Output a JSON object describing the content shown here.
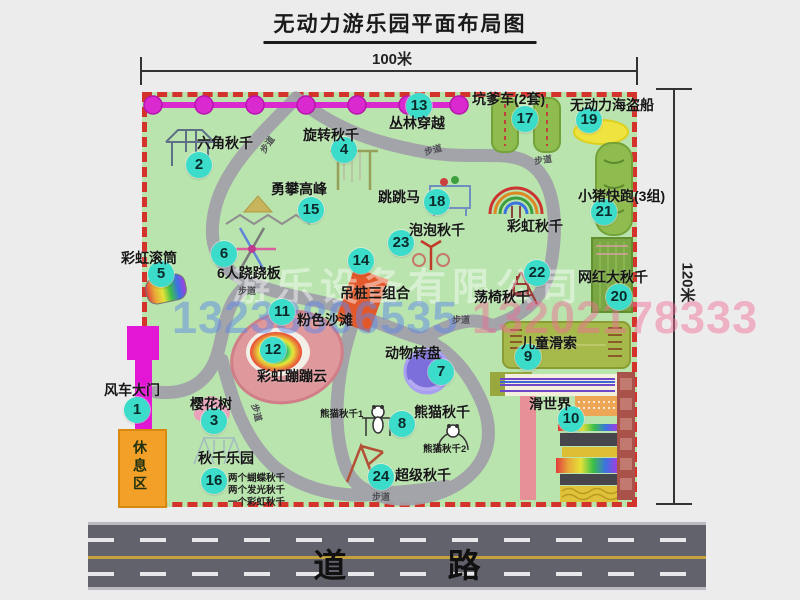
{
  "title": "无动力游乐园平面布局图",
  "dimensions": {
    "width_label": "100米",
    "height_label": "120米"
  },
  "road": {
    "label": "道 路"
  },
  "watermark": {
    "company": "游乐设备有限公司",
    "phone1": "13233806535",
    "phone2": "13202178333"
  },
  "rest_area_label": "休息区",
  "path_label_text": "步道",
  "items": [
    {
      "num": "1",
      "label": "风车大门",
      "bx": 137,
      "by": 410,
      "lx": 104,
      "ly": 380
    },
    {
      "num": "2",
      "label": "六角秋千",
      "bx": 199,
      "by": 165,
      "lx": 197,
      "ly": 133
    },
    {
      "num": "3",
      "label": "樱花树",
      "bx": 214,
      "by": 421,
      "lx": 190,
      "ly": 394
    },
    {
      "num": "4",
      "label": "旋转秋千",
      "bx": 344,
      "by": 150,
      "lx": 303,
      "ly": 125
    },
    {
      "num": "5",
      "label": "彩虹滚筒",
      "bx": 161,
      "by": 274,
      "lx": 121,
      "ly": 248
    },
    {
      "num": "6",
      "label": "6人跷跷板",
      "bx": 224,
      "by": 254,
      "lx": 217,
      "ly": 263
    },
    {
      "num": "7",
      "label": "动物转盘",
      "bx": 441,
      "by": 372,
      "lx": 385,
      "ly": 343
    },
    {
      "num": "8",
      "label": "熊猫秋千",
      "bx": 402,
      "by": 424,
      "lx": 414,
      "ly": 402
    },
    {
      "num": "9",
      "label": "儿童滑索",
      "bx": 528,
      "by": 357,
      "lx": 521,
      "ly": 333
    },
    {
      "num": "10",
      "label": "滑世界",
      "bx": 571,
      "by": 419,
      "lx": 529,
      "ly": 394
    },
    {
      "num": "11",
      "label": "粉色沙滩",
      "bx": 282,
      "by": 312,
      "lx": 297,
      "ly": 310
    },
    {
      "num": "12",
      "label": "彩虹蹦蹦云",
      "bx": 273,
      "by": 350,
      "lx": 257,
      "ly": 366
    },
    {
      "num": "13",
      "label": "丛林穿越",
      "bx": 419,
      "by": 106,
      "lx": 389,
      "ly": 113
    },
    {
      "num": "14",
      "label": "吊桩三组合",
      "bx": 361,
      "by": 261,
      "lx": 340,
      "ly": 283
    },
    {
      "num": "15",
      "label": "勇攀高峰",
      "bx": 311,
      "by": 210,
      "lx": 271,
      "ly": 179
    },
    {
      "num": "16",
      "label": "秋千乐园",
      "bx": 214,
      "by": 481,
      "lx": 198,
      "ly": 448
    },
    {
      "num": "17",
      "label": "坑爹车(2套)",
      "bx": 525,
      "by": 119,
      "lx": 472,
      "ly": 89
    },
    {
      "num": "18",
      "label": "跳跳马",
      "bx": 437,
      "by": 202,
      "lx": 378,
      "ly": 187
    },
    {
      "num": "19",
      "label": "无动力海盗船",
      "bx": 589,
      "by": 120,
      "lx": 570,
      "ly": 95
    },
    {
      "num": "20",
      "label": "网红大秋千",
      "bx": 619,
      "by": 297,
      "lx": 578,
      "ly": 267
    },
    {
      "num": "21",
      "label": "小猪快跑(3组)",
      "bx": 604,
      "by": 212,
      "lx": 578,
      "ly": 186
    },
    {
      "num": "22",
      "label": "荡椅秋千",
      "bx": 537,
      "by": 273,
      "lx": 474,
      "ly": 287
    },
    {
      "num": "23",
      "label": "泡泡秋千",
      "bx": 401,
      "by": 243,
      "lx": 409,
      "ly": 220
    },
    {
      "num": "24",
      "label": "超级秋千",
      "bx": 381,
      "by": 477,
      "lx": 395,
      "ly": 465
    }
  ],
  "extra_labels": [
    {
      "text": "彩虹秋千",
      "x": 507,
      "y": 216,
      "big": true
    },
    {
      "text": "熊猫秋千1",
      "x": 320,
      "y": 406
    },
    {
      "text": "熊猫秋千2",
      "x": 423,
      "y": 441
    },
    {
      "text": "两个蝴蝶秋千",
      "x": 228,
      "y": 470
    },
    {
      "text": "两个发光秋千",
      "x": 228,
      "y": 482
    },
    {
      "text": "一个彩虹秋千",
      "x": 228,
      "y": 494
    }
  ],
  "path_labels": [
    {
      "x": 258,
      "y": 138,
      "rot": -55
    },
    {
      "x": 424,
      "y": 143,
      "rot": -15
    },
    {
      "x": 534,
      "y": 153,
      "rot": -8
    },
    {
      "x": 238,
      "y": 284,
      "rot": 0
    },
    {
      "x": 452,
      "y": 313,
      "rot": 0
    },
    {
      "x": 248,
      "y": 406,
      "rot": 75
    },
    {
      "x": 372,
      "y": 490,
      "rot": 0
    }
  ]
}
